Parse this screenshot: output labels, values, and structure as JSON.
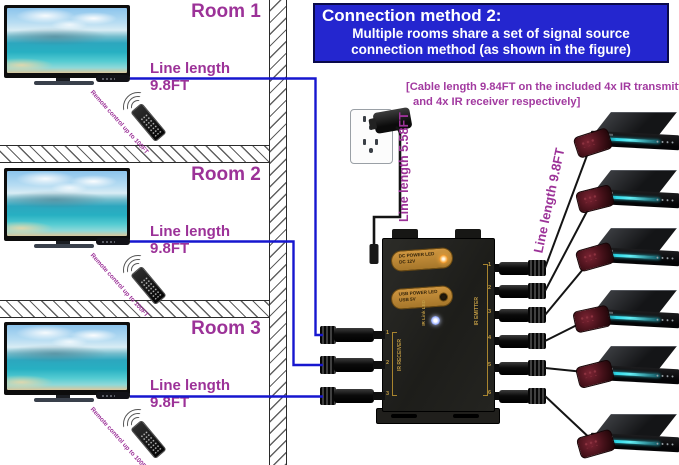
{
  "title_box": {
    "heading": "Connection method 2:",
    "line1": "Multiple rooms share a set of signal source",
    "line2": "connection method (as shown in the figure)"
  },
  "note": {
    "line1": "[Cable length 9.84FT on the included 4x IR transmitter",
    "line2": "and 4x IR receiver respectively]"
  },
  "rooms": [
    {
      "label": "Room 1",
      "cable_label": "Line length 9.8FT",
      "remote_note": "Remote control up to 100FT"
    },
    {
      "label": "Room 2",
      "cable_label": "Line length 9.8FT",
      "remote_note": "Remote control up to 100FT"
    },
    {
      "label": "Room 3",
      "cable_label": "Line length 9.8FT",
      "remote_note": "Remote control up to 100FT"
    }
  ],
  "power_cable_label": "Line length 5.58FT",
  "emitter_cable_label": "Line length 9.8FT",
  "repeater": {
    "dc_led_label": "DC POWER LED",
    "dc_led_sub": "DC 12V",
    "usb_led_label": "USB POWER LED",
    "usb_led_sub": "USB 5V",
    "link_led_label": "IR Link LED",
    "receiver_side_label": "IR RECEIVER",
    "emitter_side_label": "IR EMITTER",
    "receiver_ports": [
      "1",
      "2",
      "3"
    ],
    "emitter_ports": [
      "1",
      "2",
      "3",
      "4",
      "5",
      "6"
    ]
  },
  "colors": {
    "title_bg": "#2426cf",
    "signal_line": "#1717cf",
    "label_purple": "#9c3298",
    "led_orange": "#f7a93c",
    "device_glow": "#2fd8e8"
  }
}
